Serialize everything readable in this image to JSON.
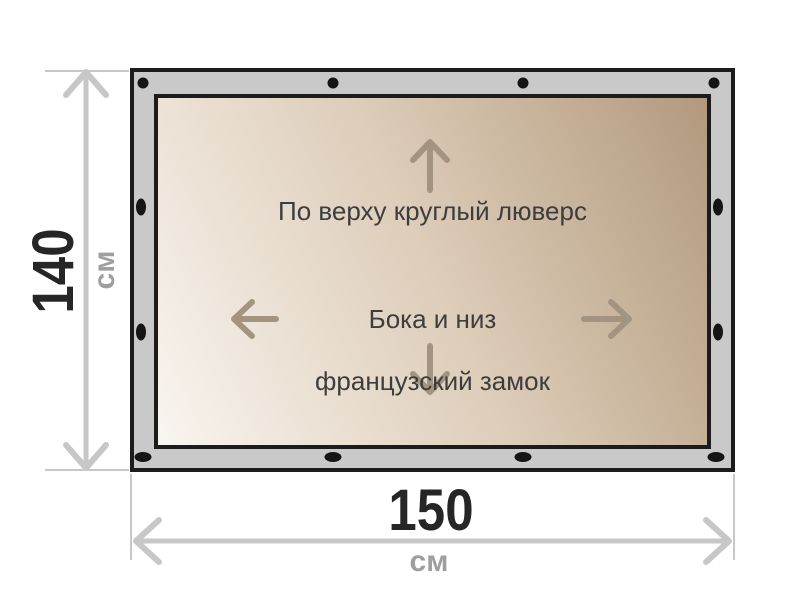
{
  "panel": {
    "top_note": "По верху круглый люверс",
    "center_note_line1": "Бока и низ",
    "center_note_line2": "французский замок"
  },
  "dimensions": {
    "height": {
      "value": "140",
      "unit": "см"
    },
    "width": {
      "value": "150",
      "unit": "см"
    }
  },
  "grommets": [
    {
      "x": 143,
      "y": 83,
      "shape": "round"
    },
    {
      "x": 333,
      "y": 83,
      "shape": "round"
    },
    {
      "x": 523,
      "y": 83,
      "shape": "round"
    },
    {
      "x": 714,
      "y": 83,
      "shape": "round"
    },
    {
      "x": 141,
      "y": 207,
      "shape": "oval-v"
    },
    {
      "x": 141,
      "y": 332,
      "shape": "oval-v"
    },
    {
      "x": 718,
      "y": 207,
      "shape": "oval-v"
    },
    {
      "x": 718,
      "y": 332,
      "shape": "oval-v"
    },
    {
      "x": 143,
      "y": 457,
      "shape": "oval-h"
    },
    {
      "x": 333,
      "y": 457,
      "shape": "oval-h"
    },
    {
      "x": 523,
      "y": 457,
      "shape": "oval-h"
    },
    {
      "x": 716,
      "y": 457,
      "shape": "oval-h"
    }
  ],
  "colors": {
    "bg": "#ffffff",
    "frame-gray": "#c9c9c9",
    "line-dark": "#1c1c1c",
    "panel-light": "#f9f5f0",
    "panel-mid": "#ddcdb9",
    "panel-dark": "#b2997d",
    "grommet": "#151515",
    "dim-gray": "#c7c7c7",
    "arrow-tan": "#a29480",
    "text-dark": "#3d3d3d",
    "num-dark": "#262626",
    "unit-gray": "#9e9e9e"
  }
}
